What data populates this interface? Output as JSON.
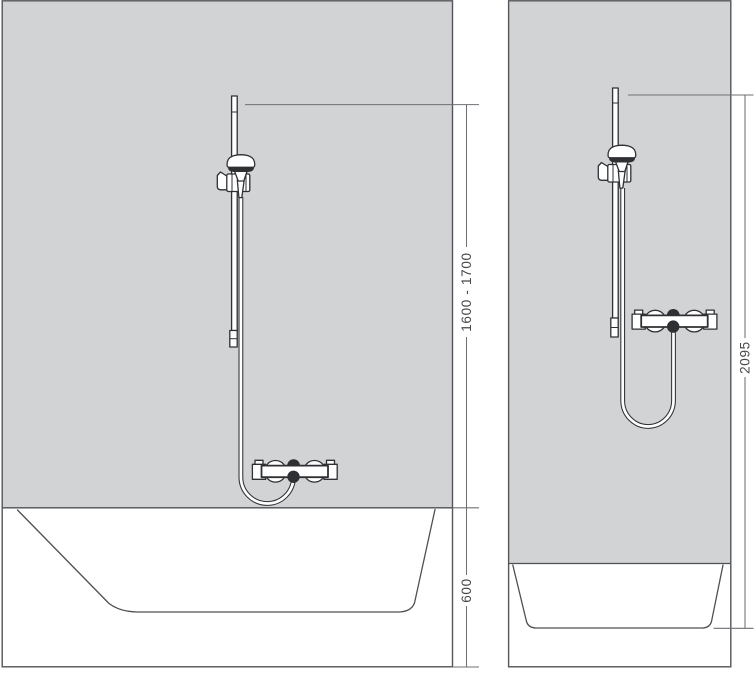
{
  "diagram": {
    "title": "shower-set-installation-dimensions",
    "colors": {
      "wall_fill": "#d2d3d5",
      "fixture_line": "#2e3033",
      "panel_line": "#54565a",
      "dimension_line": "#6e7074",
      "label_text": "#46484c",
      "background": "#ffffff"
    },
    "views": {
      "front": {
        "name": "front-view-bathtub-with-wall-bar",
        "dimensions": {
          "bar_height": {
            "label": "1600 - 1700"
          },
          "tub_rim_height": {
            "label": "600"
          }
        }
      },
      "side": {
        "name": "side-view-bathtub-with-wall-bar",
        "dimensions": {
          "bar_top_height": {
            "label": "2095"
          }
        }
      }
    },
    "components": [
      "wall-bar",
      "hand-shower",
      "shower-holder",
      "shower-hose",
      "thermostatic-mixer",
      "bathtub",
      "shower-wall"
    ]
  }
}
